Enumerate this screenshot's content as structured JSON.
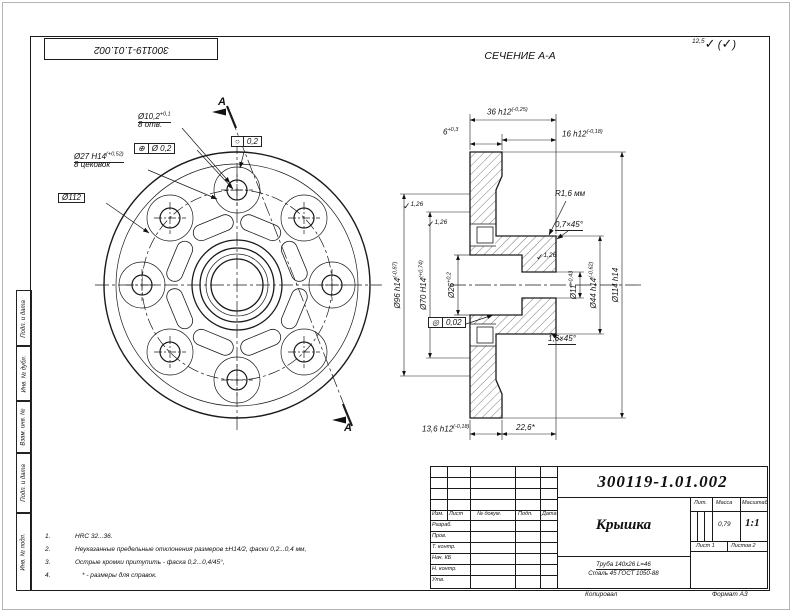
{
  "frame": {
    "stamp_number": "300119-1.01.002",
    "copied": "Копировал",
    "format": "Формат А3",
    "margin_labels": [
      "Подп. и дата",
      "Инв. № дубл.",
      "Взам. инв. №",
      "Подп. и дата",
      "Инв. № подл."
    ]
  },
  "icons": {
    "roughness_check": "✓"
  },
  "roughness": {
    "general": "12,5",
    "local": "1,26"
  },
  "section_title": "СЕЧЕНИЕ А-А",
  "front_view": {
    "section_letter": "А",
    "hole": {
      "dia": "Ø10,2",
      "tol": "+0,1",
      "count": "8 отв."
    },
    "cbore": {
      "dia": "Ø27 H14",
      "tol": "(+0,52)",
      "count": "8 цековок"
    },
    "bolt_circle": "Ø112",
    "position": {
      "sym": "⊕",
      "val": "Ø 0,2"
    },
    "circularity": {
      "sym": "○",
      "val": "0,2"
    }
  },
  "section_view": {
    "dim6": {
      "base": "6",
      "tol": "+0,3"
    },
    "dim36": {
      "base": "36 h12",
      "tol": "(-0,25)"
    },
    "dim16": {
      "base": "16 h12",
      "tol": "(-0,18)"
    },
    "dim13_6": {
      "base": "13,6 h12",
      "tol": "(-0,18)"
    },
    "dim22_6": "22,6*",
    "dia96": {
      "base": "Ø96 h14",
      "tol": "(-0,87)"
    },
    "dia70": {
      "base": "Ø70 H14",
      "tol": "(+0,74)"
    },
    "dia26": {
      "base": "Ø26",
      "tol": "+0,2"
    },
    "dia11": {
      "base": "Ø11",
      "tol": "+0,43"
    },
    "dia44": {
      "base": "Ø44 h14",
      "tol": "(-0,62)"
    },
    "dia114": "Ø114 h14",
    "radius": "R1,6 мм",
    "chamfer_small": "0,7×45°",
    "chamfer_bore": "1,6×45°",
    "concentricity": {
      "sym": "◎",
      "val": "0,02"
    }
  },
  "notes": [
    {
      "num": "1.",
      "text": "HRC 32...36."
    },
    {
      "num": "2.",
      "text": "Неуказанные предельные отклонения размеров ±Н14/2, фаски 0,2...0,4 мм,"
    },
    {
      "num": "3.",
      "text": "Острые кромки притупить - фаска 0,2...0,4/45°,"
    },
    {
      "num": "4.",
      "text": "* - размеры для справок."
    }
  ],
  "title_block": {
    "doc_number": "300119-1.01.002",
    "part_name": "Крышка",
    "lit_label": "Лит.",
    "mass_label": "Масса",
    "scale_label": "Масштаб",
    "mass": "0,79",
    "scale": "1:1",
    "sheet": "Лист 1",
    "sheets": "Листов 2",
    "material_line1": "Труба 140х26 L=46",
    "material_line2": "Сталь 45 ГОСТ 1050-88",
    "header_cells": [
      "Изм.",
      "Лист",
      "№ докум.",
      "Подп.",
      "Дата"
    ],
    "rows": [
      "Разраб.",
      "Пров.",
      "Т. контр.",
      "Нач. КБ",
      "Н. контр.",
      "Утв."
    ]
  }
}
